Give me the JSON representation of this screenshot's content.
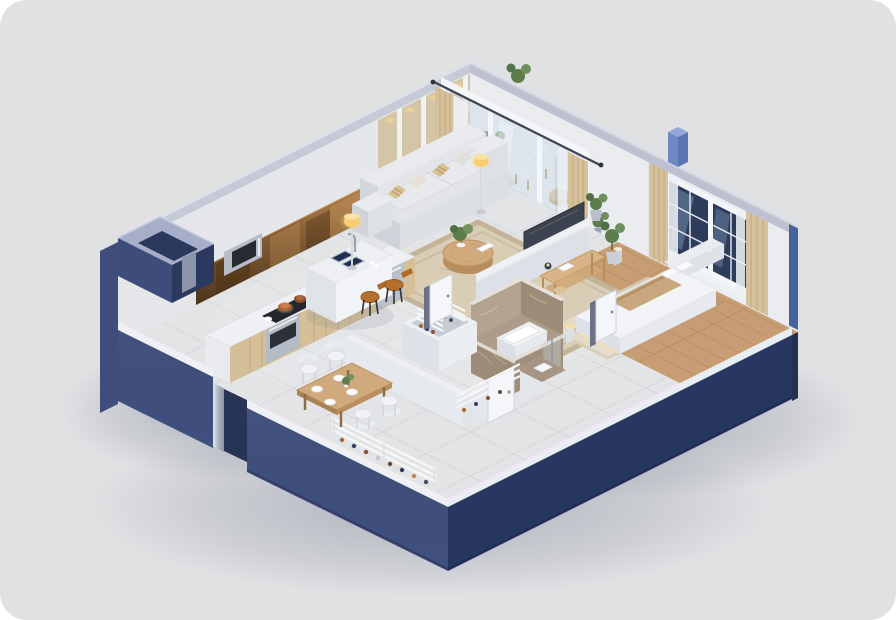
{
  "scene": {
    "title": "isometric-apartment-floorplan-render",
    "style": "3d-cutaway-one-bedroom-apartment",
    "rooms": [
      {
        "name": "kitchen",
        "furniture": [
          "mirror-backsplash",
          "microwave",
          "l-shaped-counter",
          "cooktop-with-pots",
          "oven",
          "dishwasher",
          "island-with-double-sink",
          "bar-stools"
        ]
      },
      {
        "name": "living-room",
        "furniture": [
          "panel-accent-wall",
          "three-seat-sofa",
          "striped-throw-pillows",
          "round-coffee-table",
          "floor-lamps",
          "area-rug",
          "tv-panel"
        ]
      },
      {
        "name": "balcony",
        "furniture": [
          "sliding-glass-doors",
          "linen-and-sheer-curtains",
          "wooden-armchair",
          "rattan-side-table",
          "potted-plants"
        ]
      },
      {
        "name": "bedroom",
        "furniture": [
          "double-bed",
          "headboard",
          "throw-blanket",
          "bedside-cylinder-lamps",
          "console-shelf",
          "potted-plant",
          "sash-window",
          "curtains",
          "area-rug"
        ]
      },
      {
        "name": "bathroom",
        "furniture": [
          "marble-walls",
          "bathtub",
          "glass-shower-screen"
        ]
      },
      {
        "name": "closet",
        "furniture": [
          "slatted-storage-racks"
        ]
      },
      {
        "name": "entry-hall",
        "furniture": [
          "shoe-racks",
          "interior-doors",
          "front-door"
        ]
      },
      {
        "name": "dining-area",
        "furniture": [
          "wooden-dining-table",
          "white-shell-chairs",
          "place-settings",
          "plant-centerpiece"
        ]
      }
    ]
  },
  "palette": {
    "page_background": "#ffffff",
    "card_background": "#e0e1e3",
    "plinth_left": "#41507e",
    "plinth_right": "#273760",
    "ridge": "#c6cad7",
    "wall_light": "#e9eaee",
    "accent_panel": "#d3c5a5",
    "mirror_bronze": "#7a5630",
    "floor_marble": "#e3e4e6",
    "floor_wood": "#c79e74",
    "rug_beige": "#d9cdb6",
    "sofa_fabric": "#e7e9ec",
    "stool_leather": "#b5702f",
    "curtain_linen": "#d5c19c",
    "window_glass": "#2e3c5c",
    "bath_marble": "#9d8b78",
    "lamp_glow": "#f8cd72",
    "roof_pillar_blue": "#6e88c6"
  }
}
